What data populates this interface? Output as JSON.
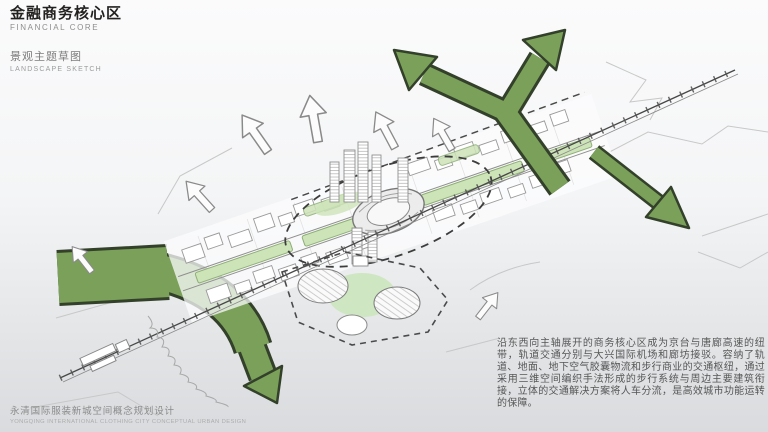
{
  "header": {
    "title_zh": "金融商务核心区",
    "title_en": "FINANCIAL CORE",
    "subtitle_zh": "景观主题草图",
    "subtitle_en": "LANDSCAPE SKETCH"
  },
  "footer": {
    "project_zh": "永清国际服装新城空间概念规划设计",
    "project_en": "YONGQING INTERNATIONAL CLOTHING CITY CONCEPTUAL URBAN DESIGN"
  },
  "description": {
    "text": "沿东西向主轴展开的商务核心区成为京台与唐廊高速的纽带，轨道交通分别与大兴国际机场和廊坊接驳。容纳了轨道、地面、地下空气胶囊物流和步行商业的交通枢纽，通过采用三维空间编织手法形成的步行系统与周边主要建筑衔接，立体的交通解决方案将人车分流，是高效城市功能运转的保障。"
  },
  "sketch": {
    "type": "hand-drawn landscape concept sketch",
    "elements": [
      "green landscape corridor arrows",
      "rail line with station",
      "east-west development axis with building blocks",
      "central circular interchange hub",
      "median park strips",
      "dome exhibition cluster",
      "outward flow arrows",
      "shoreline"
    ],
    "colors": {
      "corridor_green": "#7aa05a",
      "corridor_outline": "#33402a",
      "park_green": "#cde3b8",
      "sketch_line": "#8a8a8a",
      "rail_line": "#4a4a4a"
    }
  }
}
